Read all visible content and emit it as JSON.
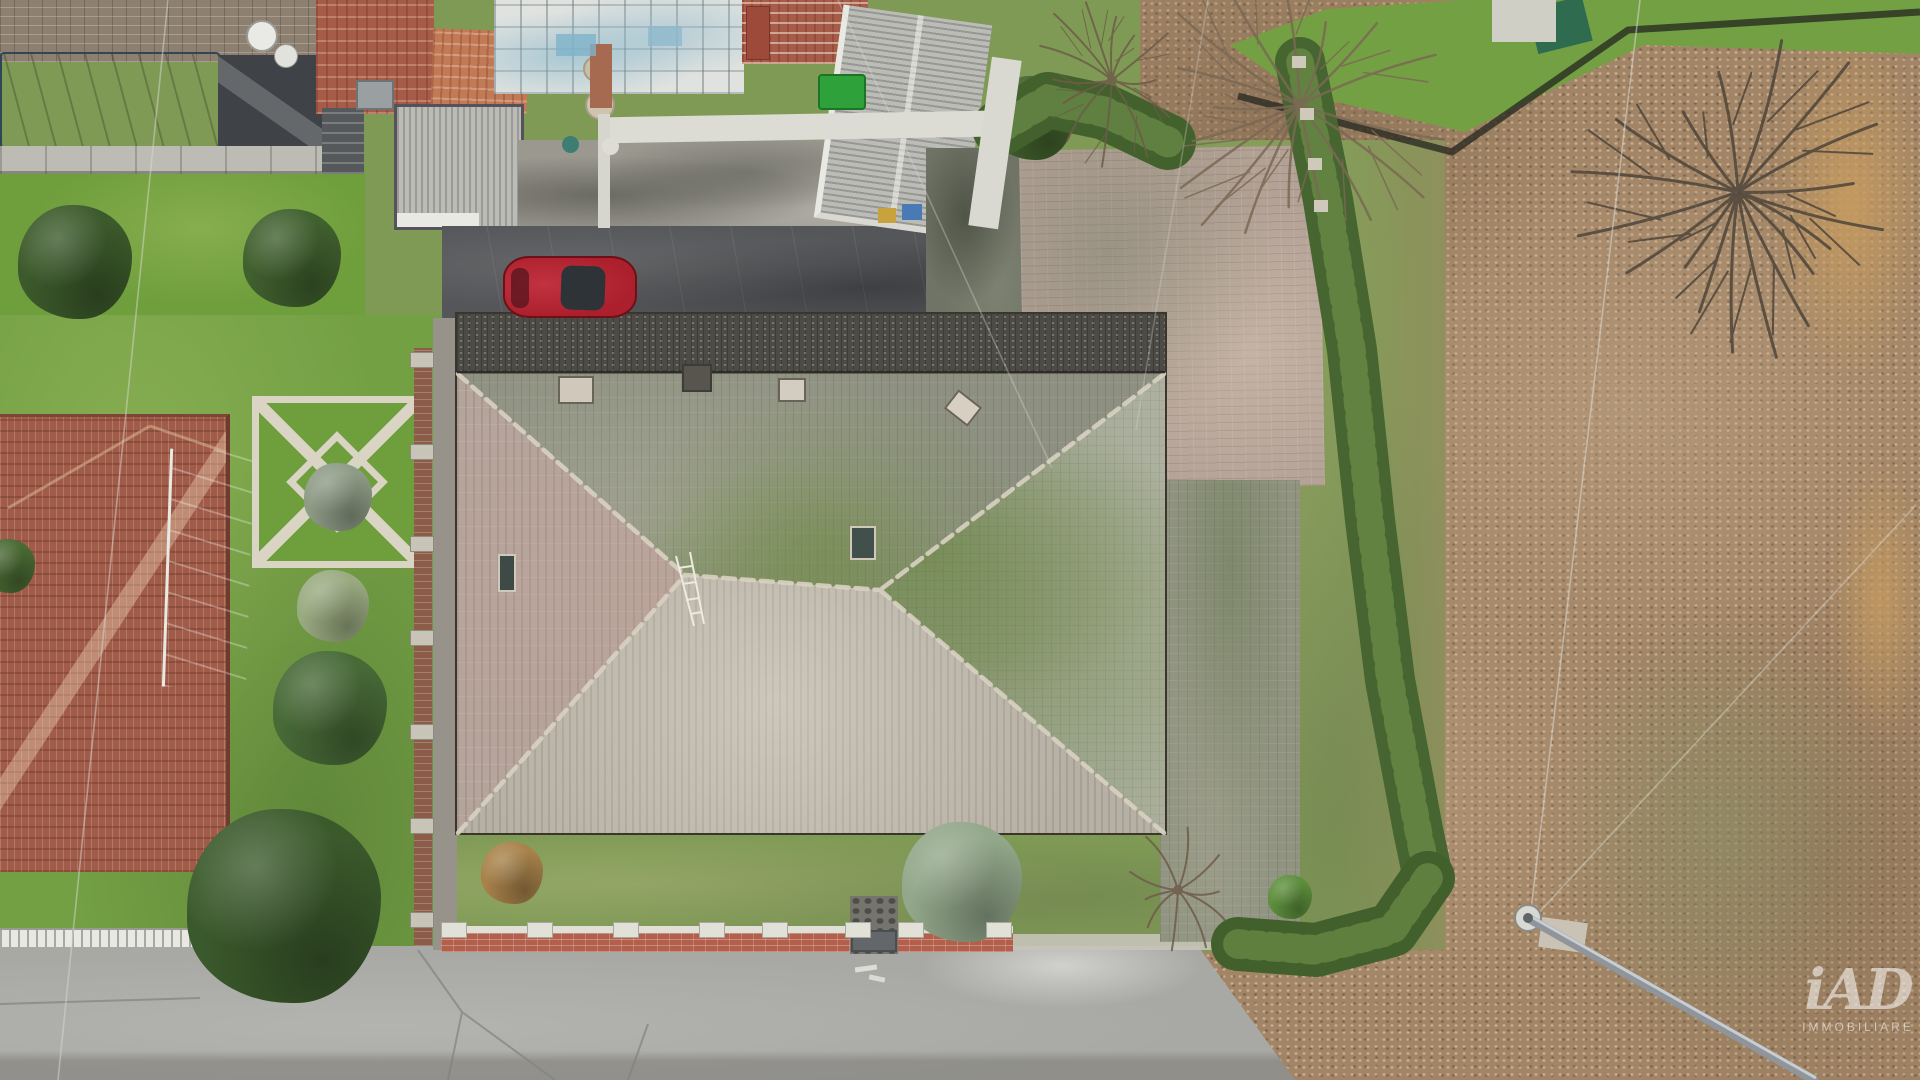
{
  "title": "Aerial drone view of a detached house with large hip roof, gardens, hedges and road",
  "watermark": {
    "logo": "iAD",
    "subtitle": "IMMOBILIARE"
  },
  "palette": {
    "grass_bright": "#6f9e3c",
    "grass_mid": "#74a044",
    "grass_dull": "#7f9a55",
    "leaf_base": "#a28566",
    "gold": "#c49a60",
    "roof_left": "#b4a59c",
    "roof_top": "#8e9181",
    "roof_right": "#99a08d",
    "roof_bottom": "#b6b0a5",
    "roof_strip": "#4c4b45",
    "roof_edge": "#3a352d",
    "ridge": "#d9d2c2",
    "terracotta": "#a55c48",
    "terracotta_lt": "#c07a55",
    "terracotta_n": "#a15c49",
    "road": "#a8a8a5",
    "drive_dark": "#55565a",
    "courtyard": "#b2a195",
    "pave_moss": "#6f7466",
    "tarp": "#48677b",
    "flat_roof": "#3f4347",
    "brickwall": "#8d8071",
    "garage": "#babcb5",
    "trim_dark": "#56515b",
    "white": "#e9e9e3",
    "concrete": "#bdbcb4",
    "fence_brick": "#b2604c",
    "coping": "#e0e0d9",
    "path_white": "#d9d4c4",
    "car": "#ac202d",
    "glass": "#2e3338",
    "bin": "#2ea13b",
    "pole": "#8f959a",
    "wire": "#d9d9d3",
    "stone": "#75746d",
    "wall_red": "#8b5c48",
    "hedge": "#466530",
    "wm": "#ffffff"
  },
  "scene": {
    "bushes": [
      {
        "name": "bush-topleft-a",
        "x": 75,
        "y": 262,
        "r": 57,
        "color": "#3c5a2b"
      },
      {
        "name": "bush-topleft-b",
        "x": 292,
        "y": 258,
        "r": 49,
        "color": "#40602e"
      },
      {
        "name": "shrub-garden-center",
        "x": 338,
        "y": 497,
        "r": 34,
        "color": "#8e9c86"
      },
      {
        "name": "shrub-light-left",
        "x": 333,
        "y": 606,
        "r": 36,
        "color": "#9aab81"
      },
      {
        "name": "bush-left-mid",
        "x": 330,
        "y": 708,
        "r": 57,
        "color": "#476a37"
      },
      {
        "name": "bush-left-edge",
        "x": 8,
        "y": 566,
        "r": 27,
        "color": "#4a6a33"
      },
      {
        "name": "bush-roadside-large",
        "x": 284,
        "y": 906,
        "r": 97,
        "color": "#3b5a2c"
      },
      {
        "name": "shrub-gold-front",
        "x": 512,
        "y": 873,
        "r": 31,
        "color": "#a8824a"
      },
      {
        "name": "juniper-blue-front",
        "x": 962,
        "y": 882,
        "r": 60,
        "color": "#93a88b"
      },
      {
        "name": "bush-bright-small",
        "x": 1290,
        "y": 897,
        "r": 22,
        "color": "#5d8f3c"
      },
      {
        "name": "hedge-clump-top",
        "x": 1032,
        "y": 118,
        "r": 42,
        "color": "#42612c"
      }
    ],
    "trees": [
      {
        "name": "bare-tree-courtyard-a",
        "x": 1112,
        "y": 80,
        "r": 88,
        "n": 13,
        "color": "#6e5c49",
        "w": 2
      },
      {
        "name": "bare-tree-courtyard-b",
        "x": 1300,
        "y": 105,
        "r": 155,
        "n": 17,
        "color": "#7b6954",
        "w": 2.5
      },
      {
        "name": "bare-tree-field",
        "x": 1738,
        "y": 192,
        "r": 170,
        "n": 18,
        "color": "#4e453b",
        "w": 3
      },
      {
        "name": "bare-shrub-road",
        "x": 1178,
        "y": 890,
        "r": 64,
        "n": 10,
        "color": "#6e5c49",
        "w": 2
      }
    ],
    "hedges": [
      {
        "name": "hedge-top-row",
        "w": 56,
        "color": "#42612c",
        "pts": [
          [
            1000,
            128
          ],
          [
            1048,
            100
          ],
          [
            1105,
            112
          ],
          [
            1168,
            142
          ]
        ]
      },
      {
        "name": "hedge-long-east",
        "w": 50,
        "color": "#466530",
        "pts": [
          [
            1300,
            62
          ],
          [
            1328,
            200
          ],
          [
            1352,
            350
          ],
          [
            1370,
            520
          ],
          [
            1390,
            680
          ],
          [
            1418,
            830
          ],
          [
            1428,
            878
          ]
        ]
      },
      {
        "name": "hedge-bottom-row",
        "w": 54,
        "color": "#41602b",
        "pts": [
          [
            1428,
            878
          ],
          [
            1392,
            930
          ],
          [
            1316,
            950
          ],
          [
            1238,
            944
          ]
        ]
      }
    ],
    "wires": [
      {
        "name": "power-line-west",
        "x1": 168,
        "y1": 0,
        "x2": 58,
        "y2": 1080,
        "o": 0.5
      },
      {
        "name": "power-line-courtyard",
        "x1": 838,
        "y1": 0,
        "x2": 1052,
        "y2": 468,
        "o": 0.35
      },
      {
        "name": "power-line-east-a",
        "x1": 1640,
        "y1": 0,
        "x2": 1530,
        "y2": 918,
        "o": 0.55
      },
      {
        "name": "power-line-east-b",
        "x1": 1916,
        "y1": 505,
        "x2": 1532,
        "y2": 920,
        "o": 0.45
      },
      {
        "name": "power-line-roof",
        "x1": 1208,
        "y1": 0,
        "x2": 1136,
        "y2": 430,
        "o": 0.3
      }
    ],
    "pole": {
      "name": "utility-pole",
      "x1": 1528,
      "y1": 918,
      "x2": 1814,
      "y2": 1080
    },
    "blocks": [
      {
        "name": "satellite-dish-large",
        "x": 246,
        "y": 20,
        "w": 32,
        "h": 32,
        "color": "#e9e9e5",
        "br": "50%",
        "border": "2px solid #9a9a94"
      },
      {
        "name": "satellite-dish-small",
        "x": 274,
        "y": 44,
        "w": 24,
        "h": 24,
        "color": "#e2e2dc",
        "br": "50%",
        "border": "1px solid #9a9a94"
      },
      {
        "name": "chimney-white-left",
        "x": 558,
        "y": 376,
        "w": 36,
        "h": 28,
        "color": "#cfc8bb",
        "border": "2px solid #6a6458"
      },
      {
        "name": "chimney-dark-center",
        "x": 682,
        "y": 364,
        "w": 30,
        "h": 28,
        "color": "#57554d",
        "border": "2px solid #3e3c36"
      },
      {
        "name": "chimney-white-mid",
        "x": 778,
        "y": 378,
        "w": 28,
        "h": 24,
        "color": "#d3ccc0",
        "border": "2px solid #6a6458"
      },
      {
        "name": "chimney-white-right",
        "x": 948,
        "y": 396,
        "w": 30,
        "h": 24,
        "color": "#d6cfc2",
        "border": "2px solid #6a6458",
        "rot": 38
      },
      {
        "name": "skylight-left",
        "x": 498,
        "y": 554,
        "w": 18,
        "h": 38,
        "color": "#3d4a46",
        "border": "2px solid #cfc8bb"
      },
      {
        "name": "skylight-right",
        "x": 850,
        "y": 526,
        "w": 26,
        "h": 34,
        "color": "#41504b",
        "border": "2px solid #cfc8bb"
      },
      {
        "name": "wheelie-bin",
        "x": 818,
        "y": 74,
        "w": 48,
        "h": 36,
        "color": "#2ea13b",
        "border": "2px solid #1c7427",
        "br": "4px"
      },
      {
        "name": "blue-crate",
        "x": 902,
        "y": 204,
        "w": 20,
        "h": 16,
        "color": "#4a7ab5"
      },
      {
        "name": "yellow-chair",
        "x": 878,
        "y": 208,
        "w": 18,
        "h": 15,
        "color": "#c8a23c"
      },
      {
        "name": "well-cover-a",
        "x": 583,
        "y": 56,
        "w": 26,
        "h": 26,
        "color": "#c9bfa8",
        "br": "50%",
        "border": "2px solid #a79d86"
      },
      {
        "name": "well-cover-b",
        "x": 585,
        "y": 90,
        "w": 30,
        "h": 30,
        "color": "#cfc5ae",
        "br": "50%",
        "border": "2px solid #a79d86"
      },
      {
        "name": "red-chimney-stack",
        "x": 746,
        "y": 6,
        "w": 24,
        "h": 54,
        "color": "#9e4a3a",
        "border": "1px solid #7c352a"
      },
      {
        "name": "white-wall-band",
        "x": 604,
        "y": 114,
        "w": 384,
        "h": 26,
        "color": "#dcdcd4",
        "rot": -1
      },
      {
        "name": "white-wall-vertical",
        "x": 598,
        "y": 114,
        "w": 12,
        "h": 114,
        "color": "#d6d6ce"
      },
      {
        "name": "white-wall-east",
        "x": 980,
        "y": 58,
        "w": 30,
        "h": 170,
        "color": "#d9d9d2",
        "rot": 8
      },
      {
        "name": "teal-planter",
        "x": 562,
        "y": 136,
        "w": 17,
        "h": 17,
        "color": "#3e7d72",
        "br": "50%"
      },
      {
        "name": "white-planter",
        "x": 602,
        "y": 138,
        "w": 17,
        "h": 17,
        "color": "#ddddd6",
        "br": "50%"
      },
      {
        "name": "brick-pillar-courtyard",
        "x": 590,
        "y": 44,
        "w": 22,
        "h": 64,
        "color": "#a56a4f"
      },
      {
        "name": "metal-gate",
        "x": 851,
        "y": 930,
        "w": 46,
        "h": 22,
        "color": "#63676a",
        "border": "2px solid #4a4e50"
      },
      {
        "name": "concrete-pad",
        "x": 1540,
        "y": 920,
        "w": 46,
        "h": 30,
        "color": "#cac3b5",
        "rot": 8
      },
      {
        "name": "garden-tent",
        "x": 1532,
        "y": 2,
        "w": 56,
        "h": 46,
        "color": "#2e6b4f",
        "rot": -14
      },
      {
        "name": "white-grid-tiles",
        "x": 1492,
        "y": 0,
        "w": 64,
        "h": 42,
        "color": "#cfcfc6",
        "cls": "grid"
      },
      {
        "name": "road-marking-a",
        "x": 855,
        "y": 966,
        "w": 22,
        "h": 5,
        "color": "#e6e6e0",
        "rot": -8,
        "op": 0.85
      },
      {
        "name": "road-marking-b",
        "x": 869,
        "y": 976,
        "w": 16,
        "h": 5,
        "color": "#e6e6e0",
        "rot": 12,
        "op": 0.8
      },
      {
        "name": "wall-post",
        "x": 410,
        "y": 352,
        "w": 24,
        "h": 16,
        "color": "#c9c4b8",
        "border": "1px solid #8f8a7e"
      },
      {
        "name": "wall-post",
        "x": 410,
        "y": 444,
        "w": 24,
        "h": 16,
        "color": "#c9c4b8",
        "border": "1px solid #8f8a7e"
      },
      {
        "name": "wall-post",
        "x": 410,
        "y": 536,
        "w": 24,
        "h": 16,
        "color": "#c9c4b8",
        "border": "1px solid #8f8a7e"
      },
      {
        "name": "wall-post",
        "x": 410,
        "y": 630,
        "w": 24,
        "h": 16,
        "color": "#c9c4b8",
        "border": "1px solid #8f8a7e"
      },
      {
        "name": "wall-post",
        "x": 410,
        "y": 724,
        "w": 24,
        "h": 16,
        "color": "#c9c4b8",
        "border": "1px solid #8f8a7e"
      },
      {
        "name": "wall-post",
        "x": 410,
        "y": 818,
        "w": 24,
        "h": 16,
        "color": "#c9c4b8",
        "border": "1px solid #8f8a7e"
      },
      {
        "name": "wall-post",
        "x": 410,
        "y": 912,
        "w": 24,
        "h": 16,
        "color": "#c9c4b8",
        "border": "1px solid #8f8a7e"
      },
      {
        "name": "fence-pillar",
        "x": 441,
        "y": 922,
        "w": 26,
        "h": 16,
        "color": "#e2e1d8",
        "border": "1px solid #a9a89e"
      },
      {
        "name": "fence-pillar",
        "x": 527,
        "y": 922,
        "w": 26,
        "h": 16,
        "color": "#e2e1d8",
        "border": "1px solid #a9a89e"
      },
      {
        "name": "fence-pillar",
        "x": 613,
        "y": 922,
        "w": 26,
        "h": 16,
        "color": "#e2e1d8",
        "border": "1px solid #a9a89e"
      },
      {
        "name": "fence-pillar",
        "x": 699,
        "y": 922,
        "w": 26,
        "h": 16,
        "color": "#e2e1d8",
        "border": "1px solid #a9a89e"
      },
      {
        "name": "fence-pillar",
        "x": 762,
        "y": 922,
        "w": 26,
        "h": 16,
        "color": "#e2e1d8",
        "border": "1px solid #a9a89e"
      },
      {
        "name": "fence-pillar",
        "x": 845,
        "y": 922,
        "w": 26,
        "h": 16,
        "color": "#e2e1d8",
        "border": "1px solid #a9a89e"
      },
      {
        "name": "fence-pillar",
        "x": 898,
        "y": 922,
        "w": 26,
        "h": 16,
        "color": "#e2e1d8",
        "border": "1px solid #a9a89e"
      },
      {
        "name": "fence-pillar",
        "x": 986,
        "y": 922,
        "w": 26,
        "h": 16,
        "color": "#e2e1d8",
        "border": "1px solid #a9a89e"
      },
      {
        "name": "wall-post-east",
        "x": 1292,
        "y": 56,
        "w": 14,
        "h": 12,
        "color": "#cfc9bb"
      },
      {
        "name": "wall-post-east",
        "x": 1300,
        "y": 108,
        "w": 14,
        "h": 12,
        "color": "#cfc9bb"
      },
      {
        "name": "wall-post-east",
        "x": 1308,
        "y": 158,
        "w": 14,
        "h": 12,
        "color": "#cfc9bb"
      },
      {
        "name": "wall-post-east",
        "x": 1314,
        "y": 200,
        "w": 14,
        "h": 12,
        "color": "#cfc9bb"
      },
      {
        "name": "greenhouse-glass-a",
        "x": 556,
        "y": 34,
        "w": 40,
        "h": 22,
        "color": "#7fb3c9",
        "op": 0.8
      },
      {
        "name": "greenhouse-glass-b",
        "x": 648,
        "y": 26,
        "w": 34,
        "h": 20,
        "color": "#8fb9cc",
        "op": 0.8
      }
    ]
  }
}
